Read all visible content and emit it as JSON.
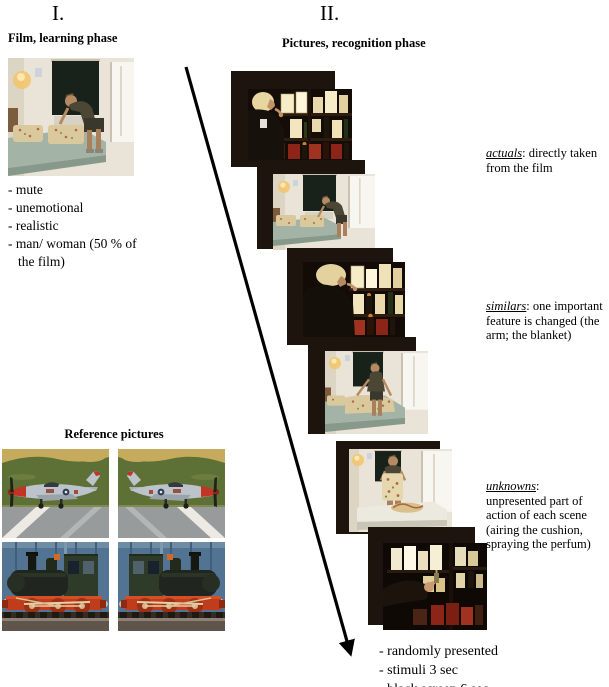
{
  "colors": {
    "background": "#ffffff",
    "black_screen": "#1d140d",
    "text": "#000000"
  },
  "left_column": {
    "section_label": "I.",
    "film_title": "Film, learning phase",
    "film_photo_description": "film still: man bending over the bed in a bedroom",
    "bullets": [
      "- mute",
      "- unemotional",
      "- realistic",
      "- man/ woman (50 % of the film)"
    ],
    "reference": {
      "title": "Reference pictures",
      "photos": [
        "airplane on airfield, nose facing left",
        "airplane on airfield, mirrored, nose facing right",
        "steam locomotive on track, cab at right",
        "steam locomotive on track, mirrored, cab at left"
      ]
    }
  },
  "right_column": {
    "section_label": "II.",
    "title": "Pictures, recognition phase",
    "stimuli": [
      {
        "category": "actual",
        "description": "woman smelling perfume at the shelf (close-up)"
      },
      {
        "category": "actual",
        "description": "man making the bed in the bedroom"
      },
      {
        "category": "similar",
        "description": "woman at the perfume shelf, the arm is changed"
      },
      {
        "category": "similar",
        "description": "man smoothing the blanket, the blanket is changed"
      },
      {
        "category": "unknown",
        "description": "man airing the cushion in the bedroom"
      },
      {
        "category": "unknown",
        "description": "arm spraying the perfume at the shelf"
      }
    ],
    "annotations": [
      {
        "term": "actuals",
        "rest": ": directly taken from the film"
      },
      {
        "term": "similars",
        "rest": ": one important feature is changed (the arm; the blanket)"
      },
      {
        "term": "unknowns",
        "rest": ": unpresented part of action of each scene (airing the cushion, spraying the perfum)"
      }
    ],
    "footer_bullets": [
      "- randomly presented",
      "- stimuli 3 sec",
      "- black screen 6 sec"
    ]
  }
}
